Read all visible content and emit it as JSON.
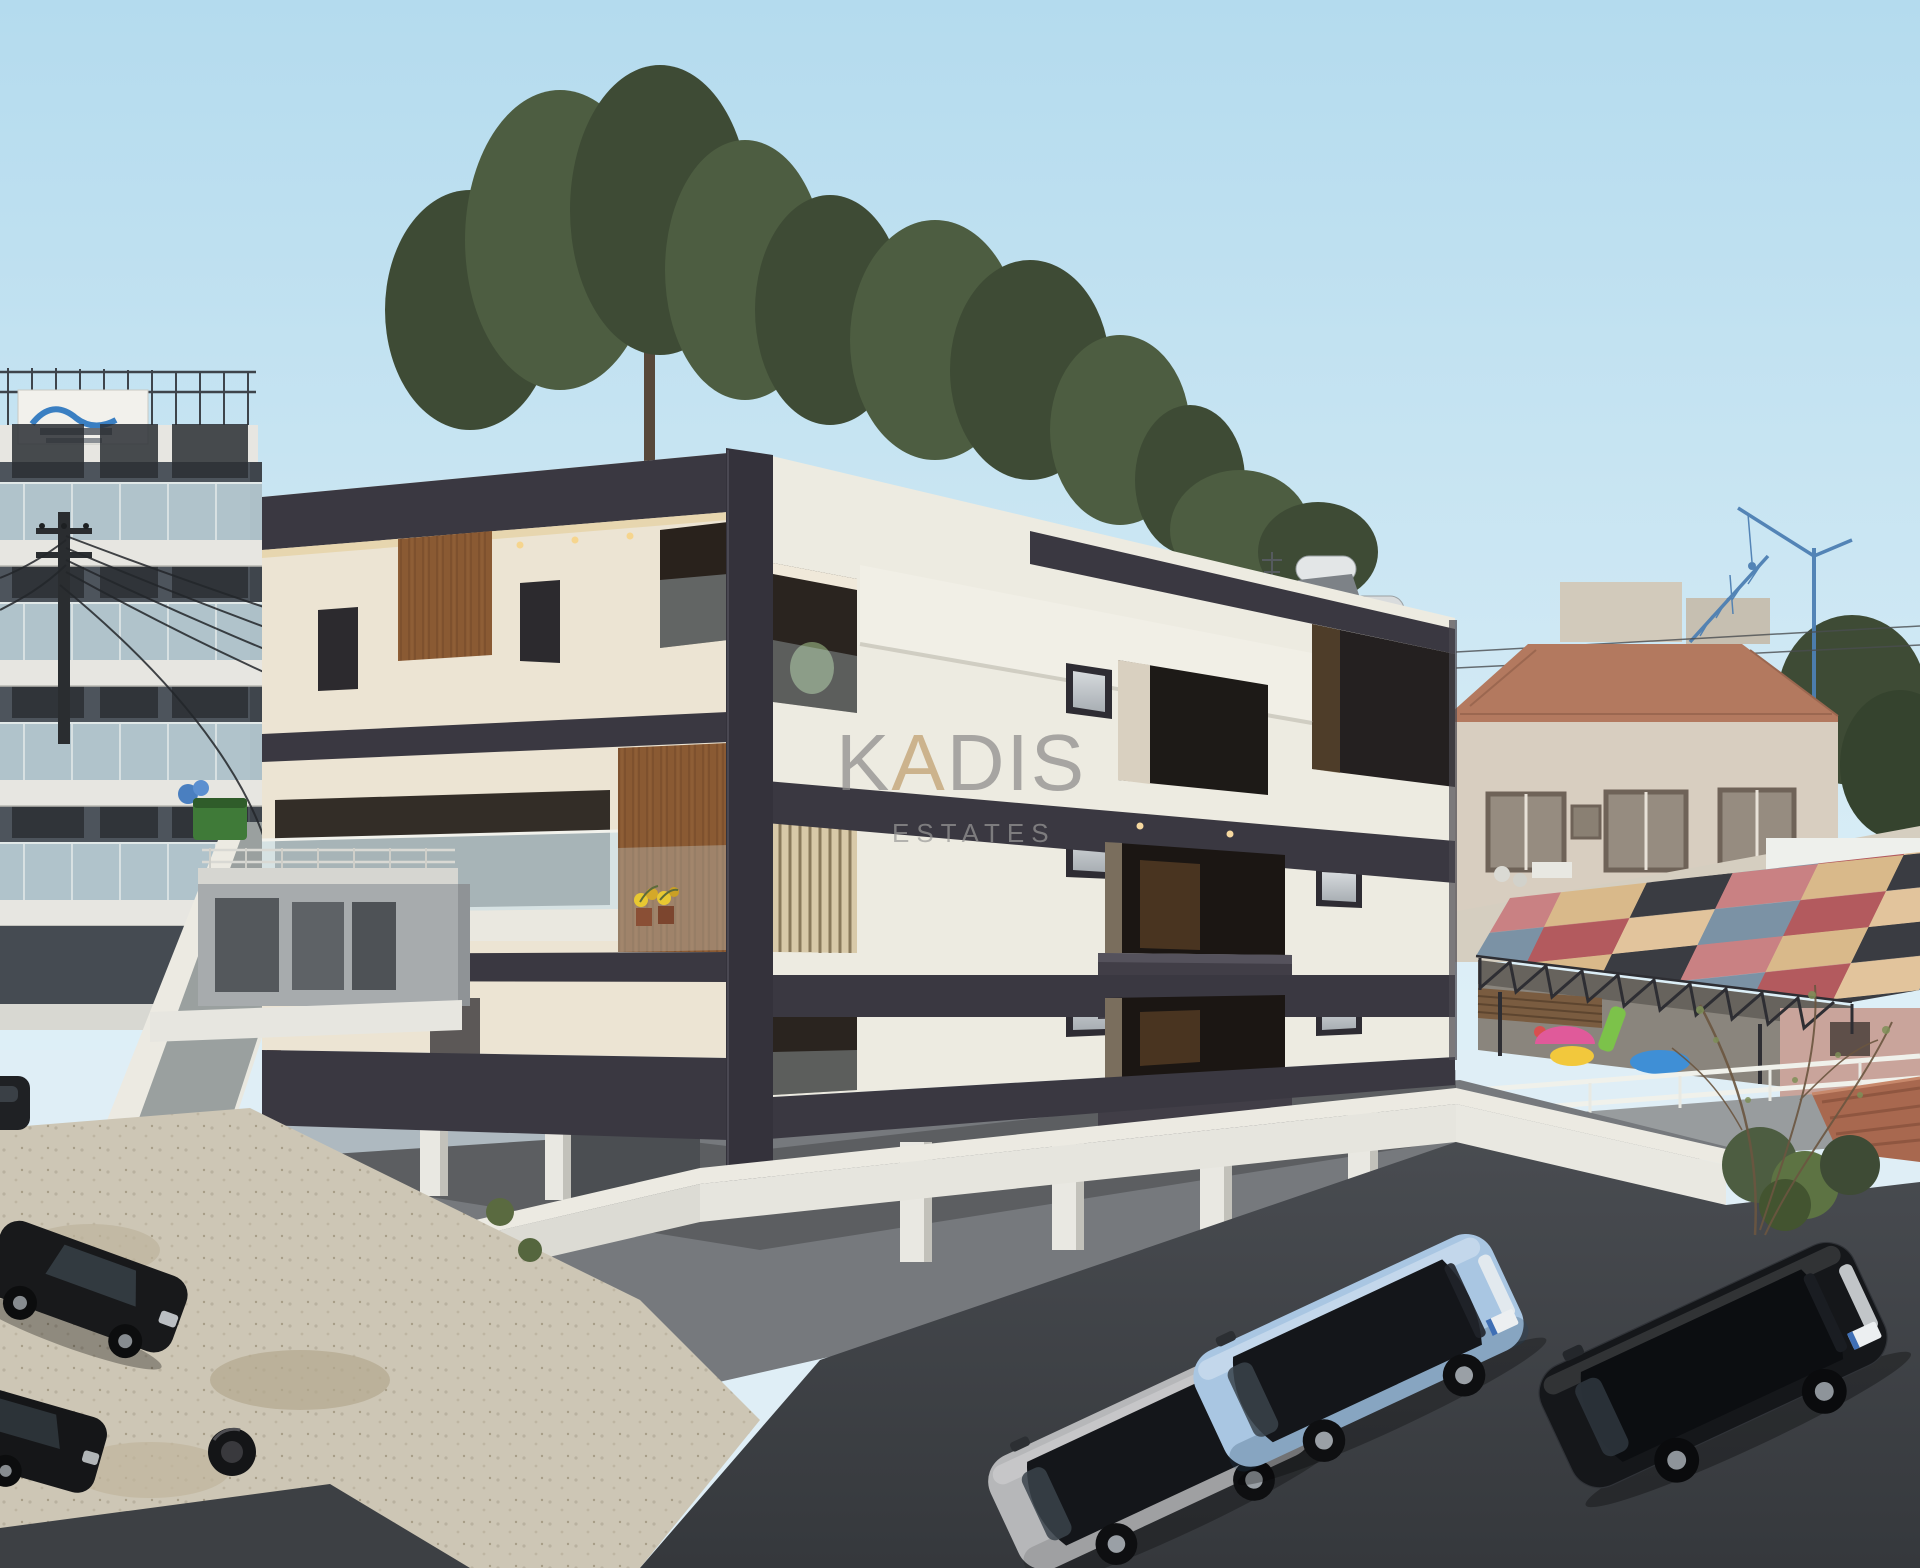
{
  "watermark": {
    "part1": "K",
    "part2": "A",
    "part3": "DIS",
    "subtitle": "ESTATES",
    "color": "#8f8e8c",
    "accent_color": "#c0a070",
    "subtitle_color": "#9a9a98"
  },
  "palette": {
    "sky_top": "#b4dbee",
    "sky_bottom": "#ddeff7",
    "building_white": "#edebe1",
    "building_cream": "#ece4d3",
    "charcoal": "#3a3841",
    "charcoal_deep": "#34323b",
    "wood": "#8a5a33",
    "wood_dark": "#6e4526",
    "glass_balcony": "#cfe2e8",
    "opening_dark": "#241f1b",
    "slab_white": "#eae8e0",
    "deck_gray": "#76797d",
    "site_wall": "#eceae2",
    "road_dark": "#44474b",
    "asphalt_deep": "#383b3f",
    "gravel": "#cdc6b5",
    "left_building": "#4d545c",
    "left_slab": "#e7e6e1",
    "left_glass": "#c9dfe7",
    "second_building": "#c2c4c0",
    "street_gray": "#9aa09f",
    "terracotta": "#b3795f",
    "house_wall": "#d8cec0",
    "crane_blue": "#4d7fb3",
    "pink_building": "#c9a49b",
    "foliage_dark": "#3e4b35",
    "foliage_mid": "#4d5d41",
    "foliage_light": "#5d7343",
    "fence_white": "#f0f1eb",
    "canopy_colors": [
      "#c98183",
      "#3a3c42",
      "#7b92a5",
      "#d9b98a",
      "#b35a5e",
      "#e2c49c"
    ]
  },
  "vehicles": {
    "parked_suvs": [
      {
        "color": "silver",
        "hex": "#b6b7b9"
      },
      {
        "color": "light-blue",
        "hex": "#a9c6e2"
      },
      {
        "color": "black",
        "hex": "#15171a"
      }
    ],
    "street_cars": [
      {
        "color": "black",
        "hex": "#18191b"
      },
      {
        "color": "black",
        "hex": "#151618"
      }
    ]
  }
}
